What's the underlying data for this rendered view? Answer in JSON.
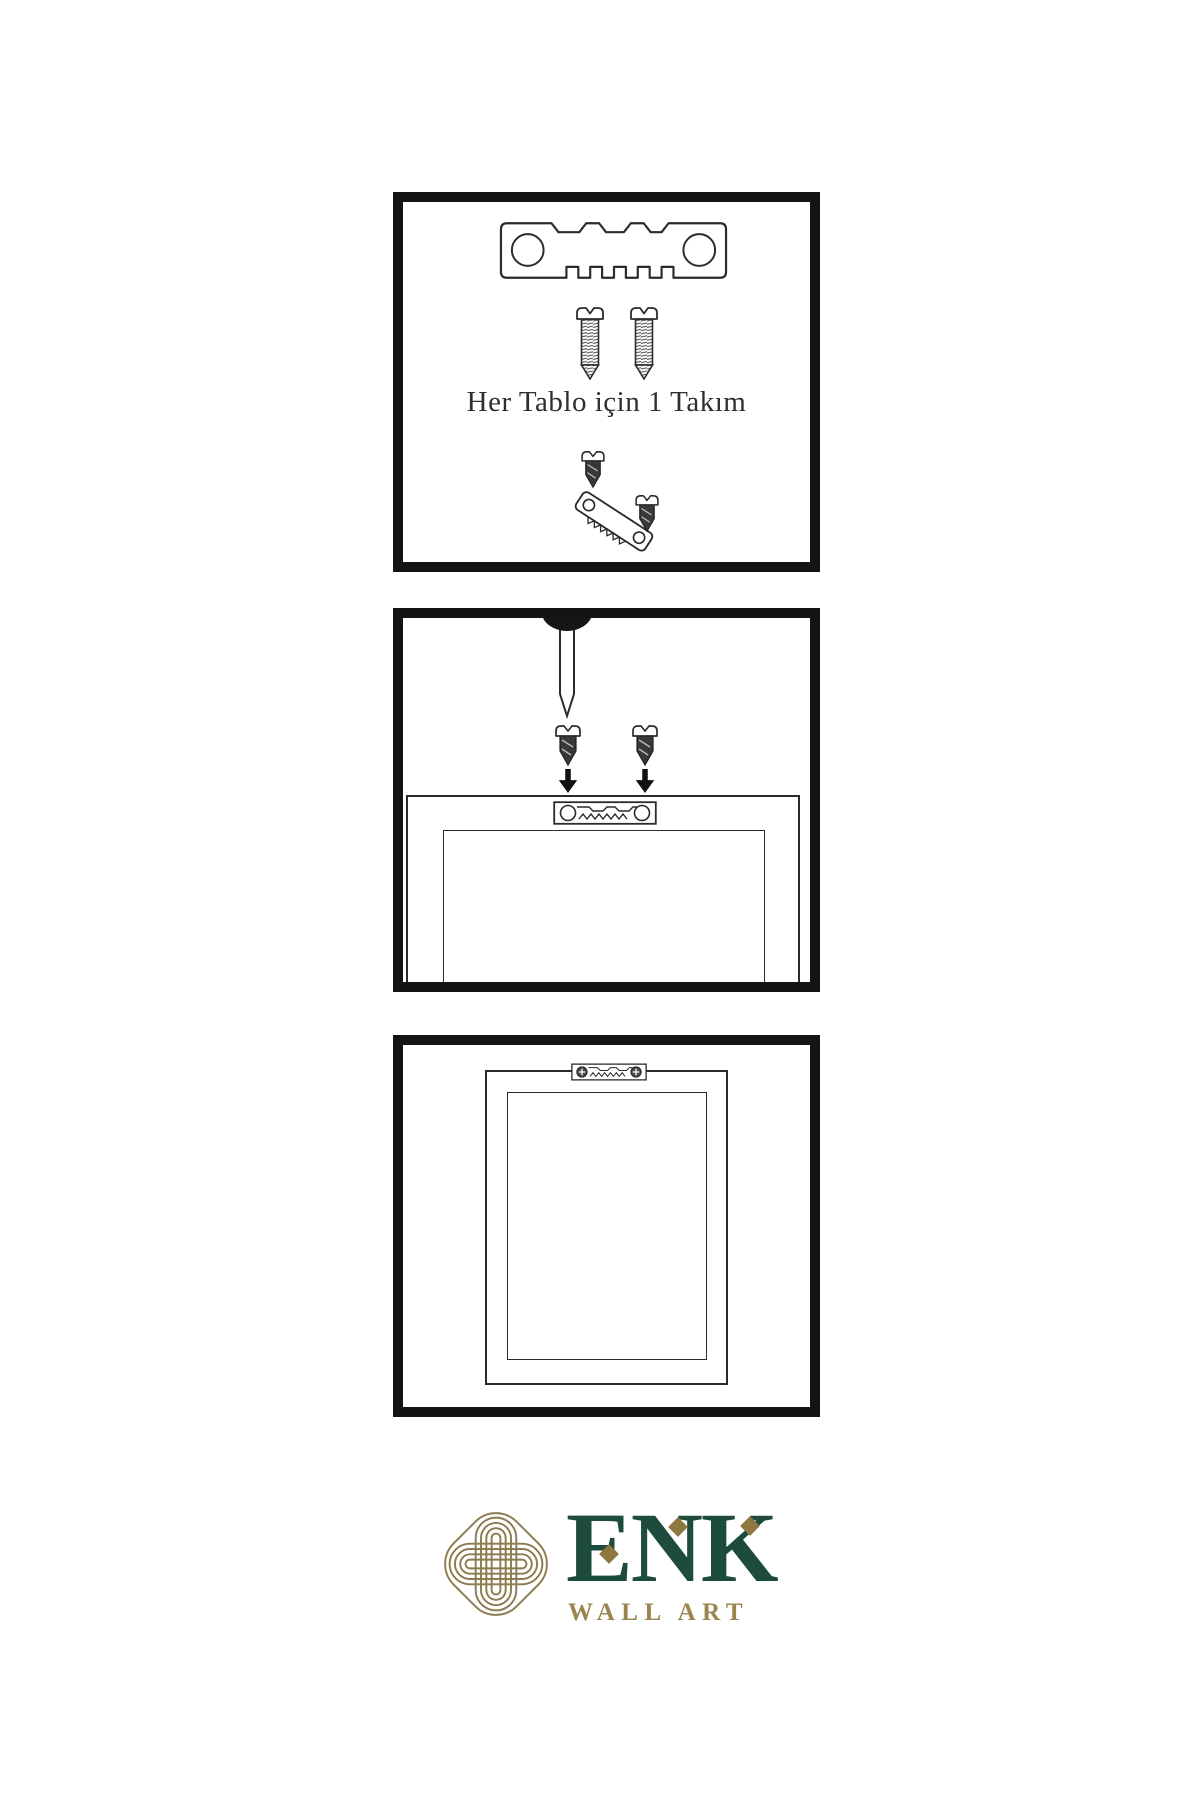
{
  "sheet": {
    "background": "#ffffff",
    "line_color": "#2b2b2b",
    "panel_border_color": "#141414"
  },
  "steps": [
    {
      "name": "hardware-kit",
      "caption": "Her Tablo için 1 Takım",
      "icons": [
        "sawtooth-hanger-icon",
        "screw-icon",
        "screw-icon",
        "screw-icon",
        "tilted-sawtooth-hanger-icon",
        "screw-icon"
      ]
    },
    {
      "name": "mount-hanger-to-frame-back",
      "caption": "",
      "icons": [
        "nail-icon",
        "dark-screw-icon",
        "dark-screw-icon",
        "down-arrow-icon",
        "down-arrow-icon",
        "frame-back-icon",
        "sawtooth-hanger-plate-icon"
      ]
    },
    {
      "name": "frame-ready-to-hang",
      "caption": "",
      "icons": [
        "frame-back-icon",
        "screwed-sawtooth-hanger-plate-icon"
      ]
    }
  ],
  "brand": {
    "name": "ENK",
    "tagline": "WALL ART",
    "logo_icon": "interlaced-knot-icon",
    "colors": {
      "green": "#1d4b3c",
      "gold_text": "#9a854e",
      "gold_accent": "#8f7740",
      "knot_gold": "#8c7c50"
    }
  }
}
